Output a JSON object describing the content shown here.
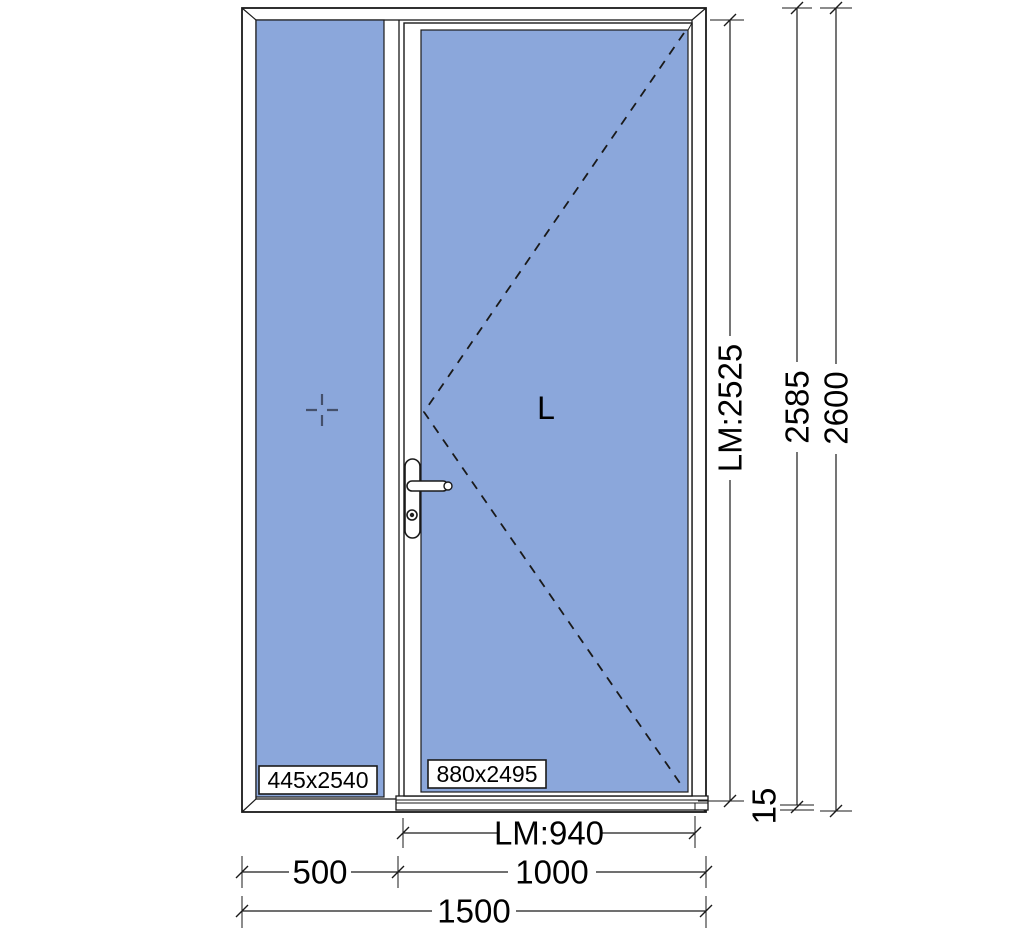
{
  "drawing": {
    "opening_symbol": "L",
    "glass_labels": {
      "side_panel": "445x2540",
      "door": "880x2495"
    },
    "dimensions": {
      "lm_width": "LM:940",
      "width_side": "500",
      "width_door": "1000",
      "width_total": "1500",
      "lm_height": "LM:2525",
      "height_2585": "2585",
      "height_2600": "2600",
      "threshold": "15"
    },
    "colors": {
      "glass": "#8BA7DB",
      "line": "#1a1a1a"
    }
  }
}
